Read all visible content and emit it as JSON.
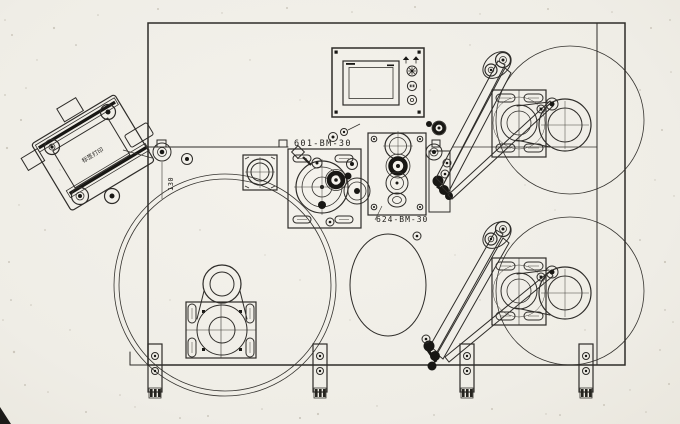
{
  "drawing": {
    "part_labels": {
      "upper_plate": "601-BM-30",
      "lower_plate": "624-BM-30"
    },
    "dimensions": {
      "printer_offset": "130"
    },
    "printer_head_label": "标签打印",
    "colors": {
      "ink": "#2e2c29",
      "paper": "#f1efe9",
      "dark_fill": "#181714"
    }
  }
}
